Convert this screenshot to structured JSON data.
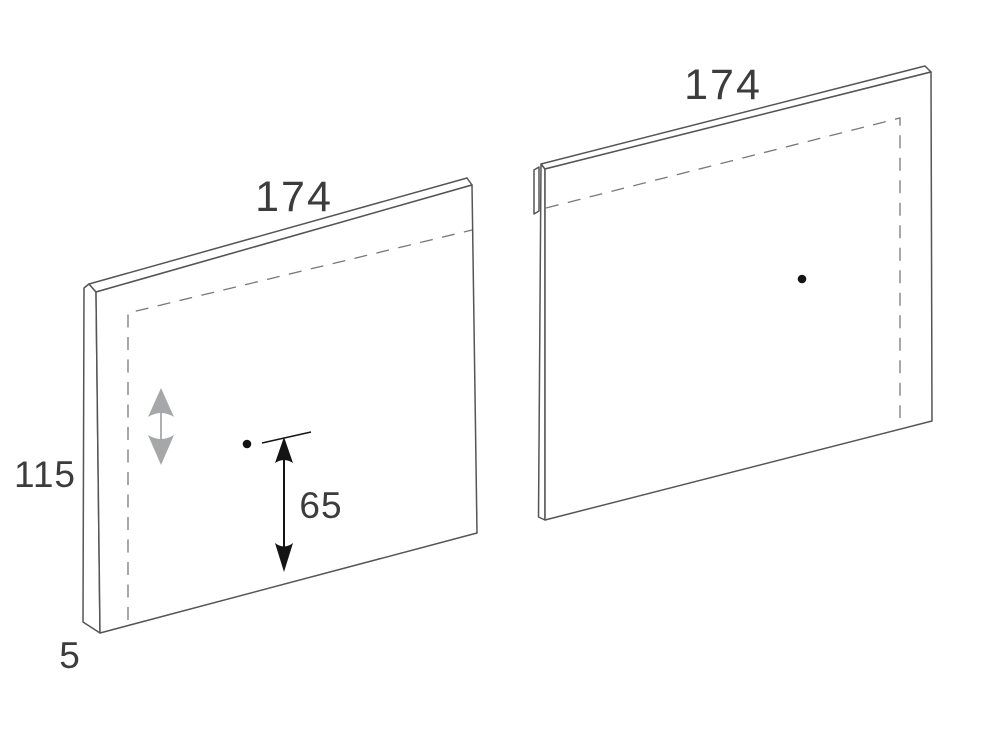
{
  "page": {
    "background": "#ffffff"
  },
  "colors": {
    "panel_outline": "#555555",
    "panel_fill": "#ffffff",
    "dashed_line": "#787878",
    "label_text": "#3c3c3c",
    "adjust_arrow": "#a6a7a9",
    "dimension_ink": "#141414"
  },
  "icons": {
    "height_adjust_arrow": "gray up-down double arrow ↕",
    "dimension_65_arrow": "black vertical double-headed dimension arrow ↕",
    "hole_dot": "filled circle •"
  },
  "panels": {
    "left": {
      "width_label": "174",
      "height_label": "115",
      "thickness_label": "5",
      "hole_offset_label": "65"
    },
    "right": {
      "width_label": "174"
    }
  }
}
